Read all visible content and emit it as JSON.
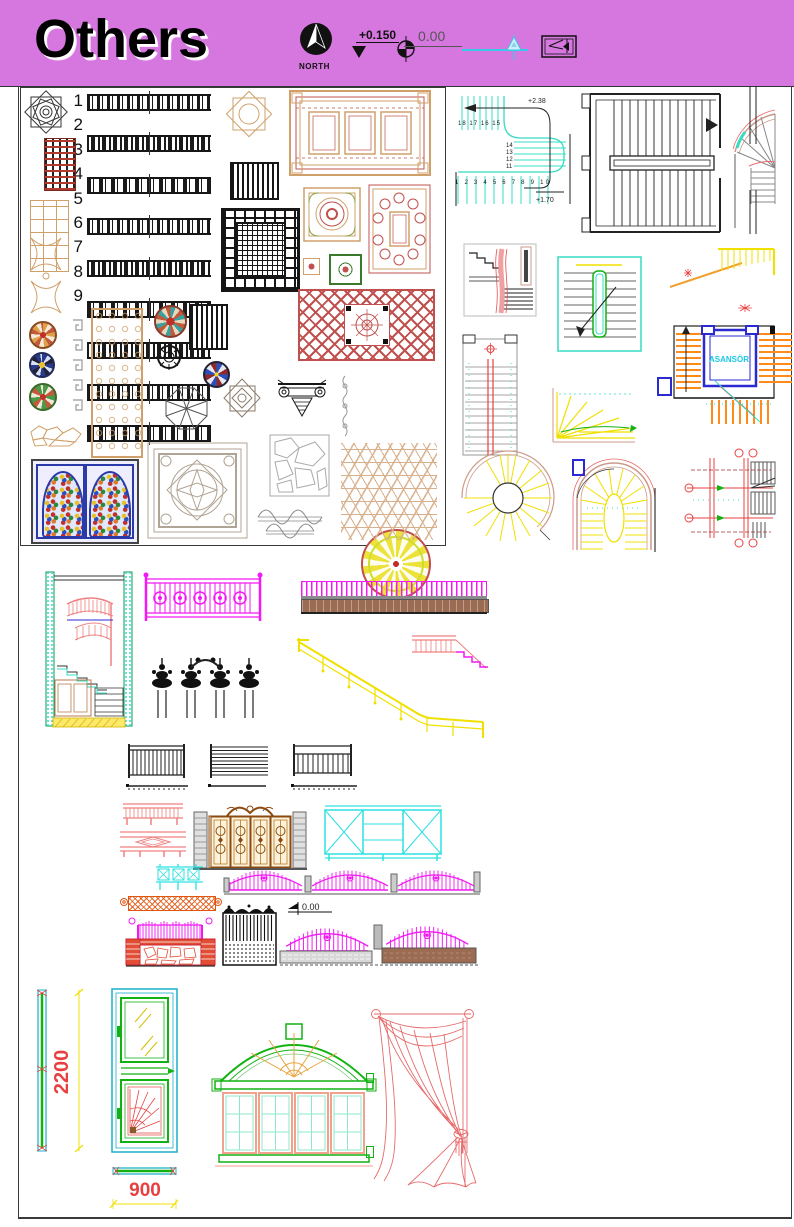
{
  "colors": {
    "header_bg": "#d677e0",
    "line_black": "#1a1a1a",
    "turquoise": "#35dcc4",
    "magenta": "#f219f2",
    "yellow": "#f0e000",
    "orange": "#ff8c1a",
    "red": "#e84040",
    "green": "#12b212",
    "tan": "#cfa06a",
    "brick_red": "#e14d35",
    "brown": "#9b6b52",
    "blue": "#2a2ad0",
    "pink": "#ff9090",
    "gate_gold": "#b97a1e"
  },
  "header": {
    "title": "Others",
    "north_label": "NORTH",
    "level_plus": "+0.150",
    "level_zero": "0.00"
  },
  "icons": {
    "north_arrow": "filled compass arrow in black circle",
    "level_triangle": "▼",
    "level_circle": "⊕",
    "section_marker": "turquoise datum line with triangle",
    "arrow_box": "◁ inside rectangle",
    "datum_flag": "◀"
  },
  "ornament_panel": {
    "strip_labels": [
      "1",
      "2",
      "3",
      "4",
      "5",
      "6",
      "7",
      "8",
      "9"
    ]
  },
  "stair_plans": {
    "turquoise_u_plan": {
      "level_upper": "+2.38",
      "level_lower": "+1.70",
      "run_top": "18 17 16 15",
      "run_right": [
        "14",
        "13",
        "12",
        "11"
      ],
      "run_bottom": "1 2 3 4 5 6 7 8 9 10"
    },
    "elevator_plan": {
      "shaft_label": "ASANSÖR"
    }
  },
  "fence_section": {
    "datum_label": "0.00"
  },
  "joinery": {
    "door_height_mm": "2200",
    "door_width_mm": "900"
  }
}
